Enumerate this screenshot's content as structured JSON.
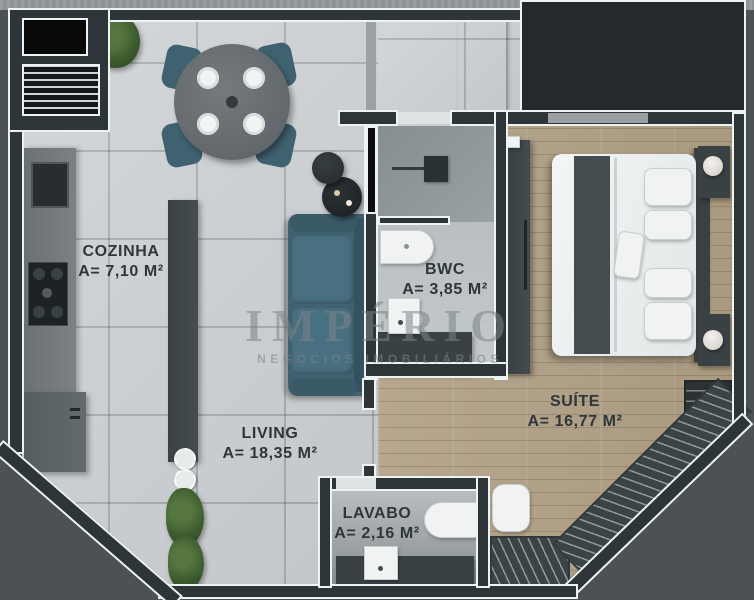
{
  "plan": {
    "type": "apartment-floor-plan",
    "watermark": {
      "brand": "IMPÉRIO",
      "tagline": "NEGÓCIOS IMOBILIÁRIOS"
    },
    "rooms": {
      "cozinha": {
        "name": "COZINHA",
        "area_label": "A= 7,10 M²"
      },
      "living": {
        "name": "LIVING",
        "area_label": "A= 18,35 M²"
      },
      "bwc": {
        "name": "BWC",
        "area_label": "A= 3,85 M²"
      },
      "suite": {
        "name": "SUÍTE",
        "area_label": "A= 16,77 M²"
      },
      "lavabo": {
        "name": "LAVABO",
        "area_label": "A= 2,16 M²"
      }
    },
    "colors": {
      "wall": "#2e3538",
      "wall_outline": "#edf2f2",
      "tile_floor": "#cfd3d6",
      "wood_floor": "#b3a28c",
      "sofa_teal": "#3f6170",
      "exterior": "#4c5155",
      "label_text": "#2f363a",
      "watermark_text": "#7a8388"
    }
  }
}
